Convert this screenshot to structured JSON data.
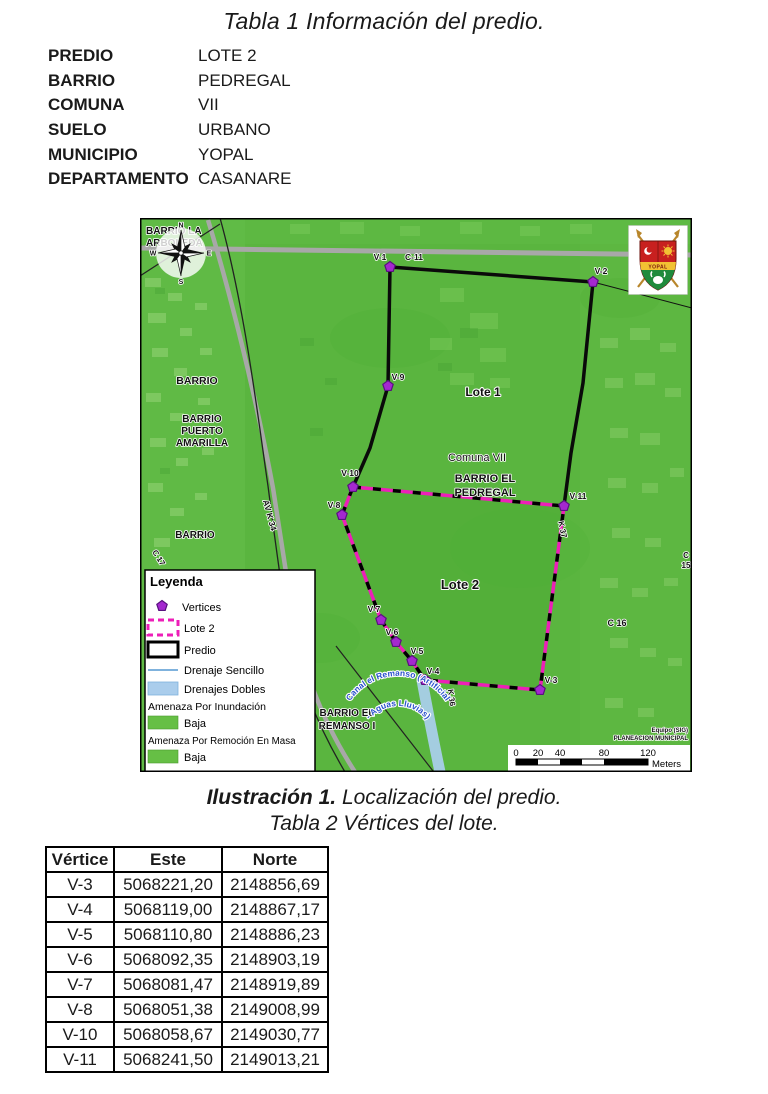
{
  "doc": {
    "title": "Tabla 1 Información del predio."
  },
  "property_table": {
    "rows": [
      {
        "label": "PREDIO",
        "value": "LOTE 2"
      },
      {
        "label": "BARRIO",
        "value": "PEDREGAL"
      },
      {
        "label": "COMUNA",
        "value": "VII"
      },
      {
        "label": "SUELO",
        "value": "URBANO"
      },
      {
        "label": "MUNICIPIO",
        "value": "YOPAL"
      },
      {
        "label": "DEPARTAMENTO",
        "value": "CASANARE"
      }
    ]
  },
  "map": {
    "region_labels": {
      "barrio_la_line1": "BARRIO LA",
      "barrio_la_line2": "ARBOLEDA",
      "barrio_left": "BARRIO",
      "barrio_puerto_line1": "BARRIO",
      "barrio_puerto_line2": "PUERTO",
      "barrio_puerto_line3": "AMARILLA",
      "barrio_left2": "BARRIO",
      "lote1": "Lote 1",
      "lote2": "Lote 2",
      "comuna": "Comuna VII",
      "barrio_pedregal_line1": "BARRIO EL",
      "barrio_pedregal_line2": "PEDREGAL",
      "barrio_remanso_line1": "BARRIO EL",
      "barrio_remanso_line2": "REMANSO I",
      "canal_line1": "Canal el Remanso (Artificial",
      "canal_line2": "- Aguas Lluvias)"
    },
    "street_labels": {
      "av_k34": "AV K 34",
      "c17": "C 17",
      "k37": "K 37",
      "k36": "K 36",
      "c16": "C 16",
      "c15_line1": "C",
      "c15_line2": "15",
      "c11": "C-11"
    },
    "vertex_labels": {
      "v1": "V-1",
      "v2": "V-2",
      "v3": "V-3",
      "v4": "V-4",
      "v5": "V-5",
      "v6": "V-6",
      "v7": "V-7",
      "v8": "V-8",
      "v9": "V-9",
      "v10": "V-10",
      "v11": "V-11"
    },
    "compass": {
      "n": "N",
      "s": "S",
      "e": "E",
      "w": "W"
    },
    "shield_text": "YOPAL",
    "legend": {
      "title": "Leyenda",
      "items": [
        {
          "label": "Vertices"
        },
        {
          "label": "Lote 2"
        },
        {
          "label": "Predio"
        },
        {
          "label": "Drenaje Sencillo"
        },
        {
          "label": "Drenajes Dobles"
        }
      ],
      "hazard_sections": [
        {
          "header": "Amenaza Por Inundación",
          "label": "Baja"
        },
        {
          "header": "Amenaza Por Remoción En Masa",
          "label": "Baja"
        }
      ]
    },
    "scale_bar": {
      "ticks": [
        "0",
        "20",
        "40",
        "80",
        "120"
      ],
      "unit": "Meters"
    },
    "credit_line1": "Equipo (SIG)",
    "credit_line2": "PLANEACION MUNICIPAL"
  },
  "captions": {
    "illustration_bold": "Ilustración 1.",
    "illustration_rest": " Localización del predio.",
    "table2_title": "Tabla 2 Vértices del lote."
  },
  "vertices_table": {
    "headers": [
      "Vértice",
      "Este",
      "Norte"
    ],
    "rows": [
      [
        "V-3",
        "5068221,20",
        "2148856,69"
      ],
      [
        "V-4",
        "5068119,00",
        "2148867,17"
      ],
      [
        "V-5",
        "5068110,80",
        "2148886,23"
      ],
      [
        "V-6",
        "5068092,35",
        "2148903,19"
      ],
      [
        "V-7",
        "5068081,47",
        "2148919,89"
      ],
      [
        "V-8",
        "5068051,38",
        "2149008,99"
      ],
      [
        "V-10",
        "5068058,67",
        "2149030,77"
      ],
      [
        "V-11",
        "5068241,50",
        "2149013,21"
      ]
    ]
  },
  "colors": {
    "map_green": "#5ab53f",
    "lote2_outline": "#ed1fb8",
    "vertex_fill": "#a428cf",
    "drainage_blue": "#aacdec",
    "hazard_green": "#66bf45"
  }
}
